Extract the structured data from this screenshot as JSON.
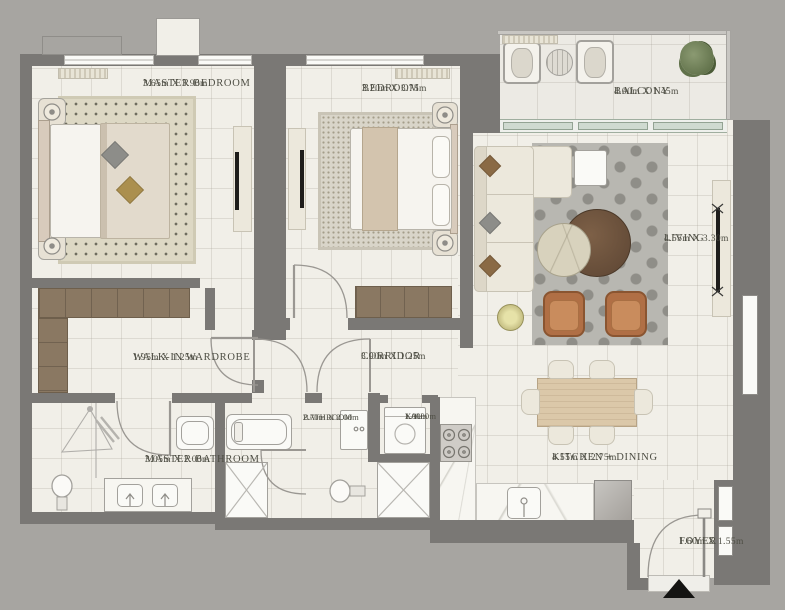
{
  "title": "Apartment floor plan",
  "colors": {
    "bg": "#a7a5a1",
    "wall": "#7a7875",
    "floor": "#f1efe8",
    "balcony_floor": "#eceae4",
    "wood_dark": "#8a7862",
    "wood_light": "#dbc8a9",
    "rust": "#b06f45",
    "rust_dark": "#8a5531",
    "cream": "#ece8dc",
    "rug_gray": "#b8b7b1",
    "rug_tan": "#ddd8c4",
    "rug_bed": "#d9d5c9",
    "fixture": "#a3a19c",
    "label": "#4e4e44",
    "glass": "#cfdad0",
    "marble": "#f7f6f1",
    "plant": "#6d7d57",
    "ink": "#141412"
  },
  "rooms": {
    "master_bedroom": {
      "label": "MASTER BEDROOM",
      "dims": "3.65m X 3.90m"
    },
    "bedroom": {
      "label": "BEDROOM",
      "dims": "3.20m X 3.75m"
    },
    "balcony": {
      "label": "BALCONY",
      "dims": "4.00m X 1.45m"
    },
    "living": {
      "label": "LIVING",
      "dims": "4.55m X 3.30m"
    },
    "walk_in_wardrobe": {
      "label": "WALK-IN WARDROBE",
      "dims": "1.95m X 1.25m"
    },
    "corridor": {
      "label": "CORRIDOR",
      "dims": "3.90m X 1.25m"
    },
    "bathroom": {
      "label": "BATHROOM",
      "dims": "2.70m X 2.00m"
    },
    "laundry": {
      "label": "LAU.",
      "dims_line1": "1.00m",
      "dims_line2": "X 1.00m"
    },
    "master_bathroom": {
      "label": "MASTER BATHROOM",
      "dims": "3.05m X 2.00m"
    },
    "kitchen_dining": {
      "label": "KITCHEN + DINING",
      "dims": "4.55m X 2.75m"
    },
    "foyer": {
      "label": "FOYER",
      "dims": "1.60m X 1.55m"
    }
  }
}
